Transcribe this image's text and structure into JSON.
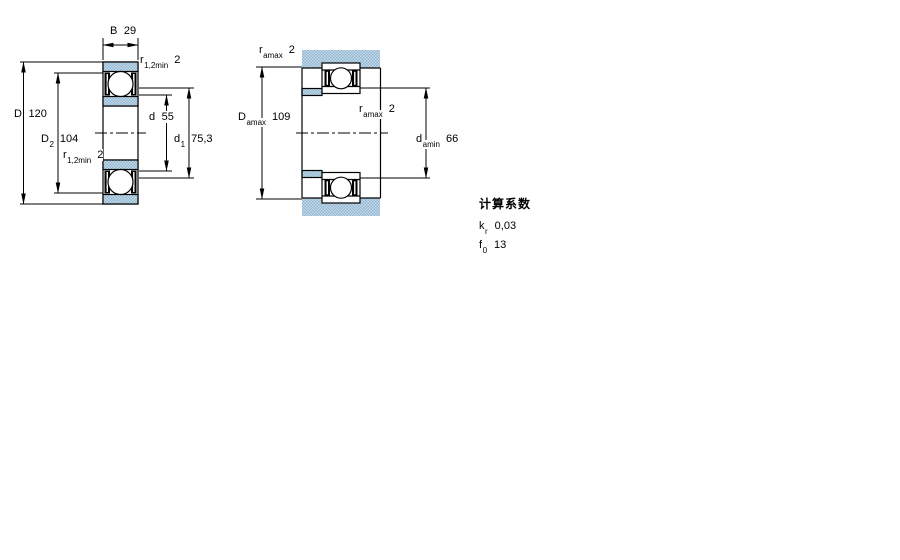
{
  "dims": {
    "B": {
      "sym": "B",
      "sub": "",
      "val": "29"
    },
    "r12_top": {
      "sym": "r",
      "sub": "1,2min",
      "val": "2"
    },
    "D": {
      "sym": "D",
      "sub": "",
      "val": "120"
    },
    "D2": {
      "sym": "D",
      "sub": "2",
      "val": "104"
    },
    "r12_bot": {
      "sym": "r",
      "sub": "1,2min",
      "val": "2"
    },
    "d": {
      "sym": "d",
      "sub": "",
      "val": "55"
    },
    "d1": {
      "sym": "d",
      "sub": "1",
      "val": "75,3"
    },
    "ra_top": {
      "sym": "r",
      "sub": "amax",
      "val": "2"
    },
    "Damax": {
      "sym": "D",
      "sub": "amax",
      "val": "109"
    },
    "ra_mid": {
      "sym": "r",
      "sub": "amax",
      "val": "2"
    },
    "damin": {
      "sym": "d",
      "sub": "amin",
      "val": "66"
    }
  },
  "factors": {
    "title": "计算系数",
    "rows": [
      {
        "sym": "k",
        "sub": "r",
        "val": "0,03"
      },
      {
        "sym": "f",
        "sub": "0",
        "val": "13"
      }
    ]
  },
  "colors": {
    "hatch_light": "#c9dcea",
    "hatch_dark": "#8fb4d0",
    "line": "#000000"
  }
}
